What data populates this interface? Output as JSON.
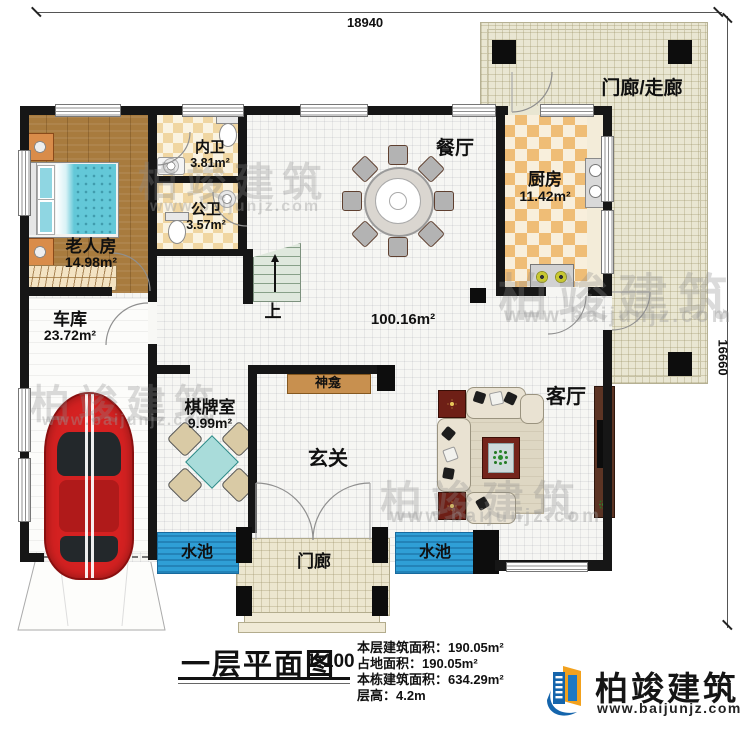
{
  "dimensions": {
    "top": "18940",
    "right": "16660"
  },
  "watermark": {
    "brand": "柏竣建筑",
    "site": "www.baijunjz.com"
  },
  "rooms": {
    "porch_corridor": {
      "label": "门廊/走廊"
    },
    "dining": {
      "label": "餐厅"
    },
    "kitchen": {
      "label": "厨房",
      "area": "11.42m²"
    },
    "inner_bath": {
      "label": "内卫",
      "area": "3.81m²"
    },
    "public_bath": {
      "label": "公卫",
      "area": "3.57m²"
    },
    "elder_room": {
      "label": "老人房",
      "area": "14.98m²"
    },
    "garage": {
      "label": "车库",
      "area": "23.72m²"
    },
    "chess_room": {
      "label": "棋牌室",
      "area": "9.99m²"
    },
    "hall": {
      "area": "100.16m²"
    },
    "shrine": {
      "label": "神龛"
    },
    "foyer": {
      "label": "玄关"
    },
    "living": {
      "label": "客厅"
    },
    "stairs": {
      "label": "上"
    },
    "pool_left": {
      "label": "水池"
    },
    "pool_right": {
      "label": "水池"
    },
    "porch_bottom": {
      "label": "门廊"
    }
  },
  "title_block": {
    "title": "一层平面图",
    "scale": "1:100",
    "info": [
      {
        "label": "本层建筑面积：",
        "value": "190.05m²"
      },
      {
        "label": "占地面积：",
        "value": "190.05m²"
      },
      {
        "label": "本栋建筑面积：",
        "value": "634.29m²"
      },
      {
        "label": "层高：",
        "value": "4.2m"
      }
    ]
  },
  "logo": {
    "brand": "柏竣建筑",
    "site": "www.baijunjz.com"
  }
}
